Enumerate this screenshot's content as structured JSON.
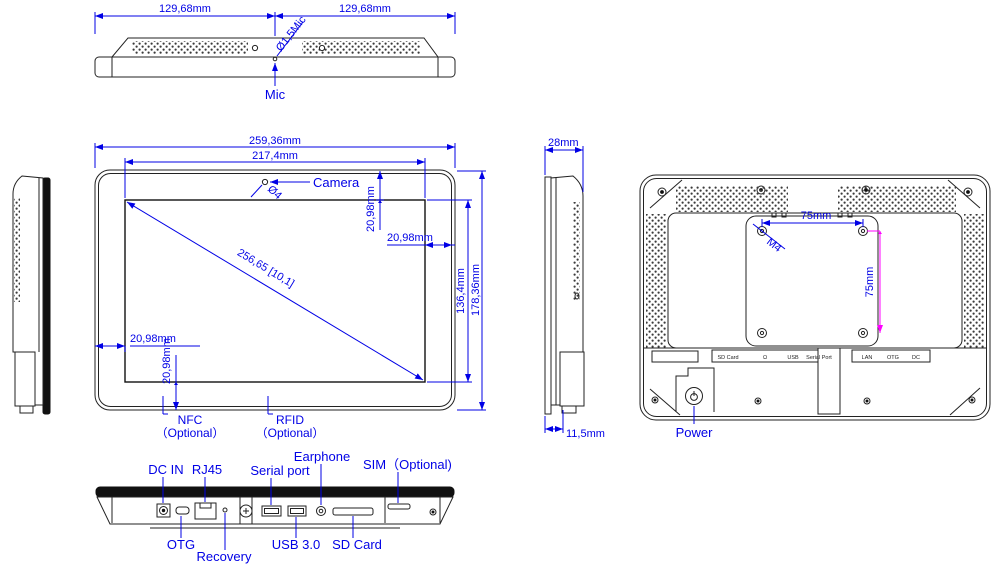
{
  "meta": {
    "drawing_type": "mechanical dimension drawing - 10.1 inch panel PC, six views",
    "colors": {
      "dimension_blue": "#0000e6",
      "vesa_magenta": "#ff00ff",
      "line_black": "#222222"
    }
  },
  "views": {
    "top": {
      "dim_left": "129,68mm",
      "dim_right": "129,68mm",
      "mic_dia": "Ø1,5Mic",
      "mic": "Mic"
    },
    "front": {
      "total_w": "259,36mm",
      "screen_w": "217,4mm",
      "camera": "Camera",
      "camera_dia": "Ø4",
      "off_top": "20,98mm",
      "off_right": "20,98mm",
      "off_left": "20,98mm",
      "off_bottom": "20,98mm",
      "diagonal": "256,65 [10,1]",
      "screen_h": "136,4mm",
      "total_h": "178,36mm",
      "nfc": "NFC",
      "nfc_opt": "（Optional）",
      "rfid": "RFID",
      "rfid_opt": "（Optional）"
    },
    "side": {
      "thickness": "28mm",
      "foot": "11,5mm"
    },
    "back": {
      "vesa_w": "75mm",
      "vesa_h": "75mm",
      "screw": "M4",
      "power": "Power",
      "strip_left": {
        "sd": "SD Card",
        "jack": "Ω",
        "usb": "USB",
        "serial": "Serial Port"
      },
      "strip_right": {
        "lan": "LAN",
        "otg": "OTG",
        "dc": "DC"
      }
    },
    "bottom": {
      "dc_in": "DC IN",
      "rj45": "RJ45",
      "serial": "Serial port",
      "earphone": "Earphone",
      "sim": "SIM（Optional)",
      "otg": "OTG",
      "recovery": "Recovery",
      "usb": "USB 3.0",
      "sd": "SD Card"
    }
  }
}
